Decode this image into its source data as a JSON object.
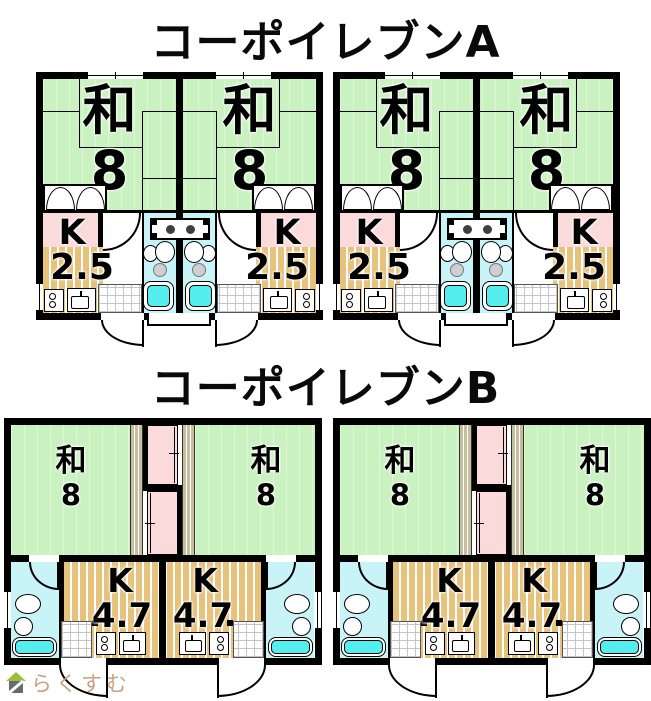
{
  "page": {
    "background": "#ffffff"
  },
  "buildings": [
    {
      "title": "コーポイレブンA",
      "room": {
        "label": "和",
        "size": "8"
      },
      "kitchen": {
        "label": "K",
        "size": "2.5"
      }
    },
    {
      "title": "コーポイレブンB",
      "room": {
        "label": "和",
        "size": "8"
      },
      "kitchen": {
        "label": "K",
        "size": "4.7"
      }
    }
  ],
  "watermark": {
    "brand": "らくすむ"
  },
  "colors": {
    "tatami_green": "#c9f2c0",
    "closet_pink": "#fadada",
    "kitchen_floor_tan": "#e7c27b",
    "bath_floor_cyan": "#c8f4f8",
    "bathtub_cyan": "#55eeee",
    "wall_black": "#000000",
    "hall_khaki": "#c7be9f",
    "watermark_brown": "#c9a183",
    "logo_roof_green": "#9dc13d"
  }
}
